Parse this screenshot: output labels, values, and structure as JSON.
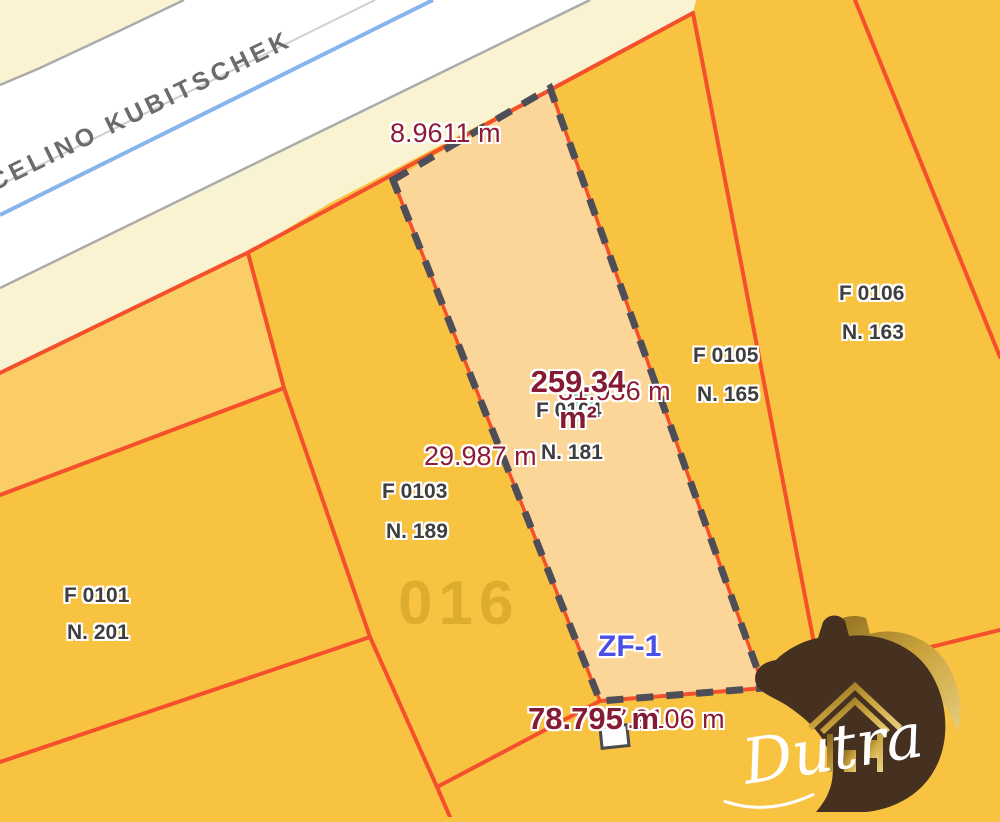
{
  "map": {
    "street": {
      "name": "JUSCELINO KUBITSCHEK"
    },
    "selected_lot": {
      "parcel_code": "F 0104",
      "parcel_number": "N. 181",
      "area_value": "259.34",
      "area_unit": "m²",
      "perimeter": "78.795 m",
      "front_measure": "8.9611 m",
      "left_side_measure": "29.987 m",
      "right_side_measure": "31.936 m",
      "back_measure": "7.9106 m",
      "zone_label": "ZF-1"
    },
    "block_number": "016",
    "parcels": [
      {
        "code": "F 0101",
        "number": "N. 201"
      },
      {
        "code": "F 0103",
        "number": "N. 189"
      },
      {
        "code": "F 0105",
        "number": "N. 165"
      },
      {
        "code": "F 0106",
        "number": "N. 163"
      }
    ],
    "colors": {
      "parcel_fill": "#F9C342",
      "selected_lot_fill": "#FBD698",
      "strip_parcel_fill": "#FBCD66",
      "sidewalk_cream": "#FAF3D2",
      "boundary_red": "#F4502B",
      "selection_dash_gray": "#4E4E58",
      "street_centerline_blue": "#85B5EA",
      "measurement_maroon": "#8C1B38",
      "zone_blue": "#4A50E6"
    }
  },
  "watermark": {
    "brand": "Dutra"
  }
}
